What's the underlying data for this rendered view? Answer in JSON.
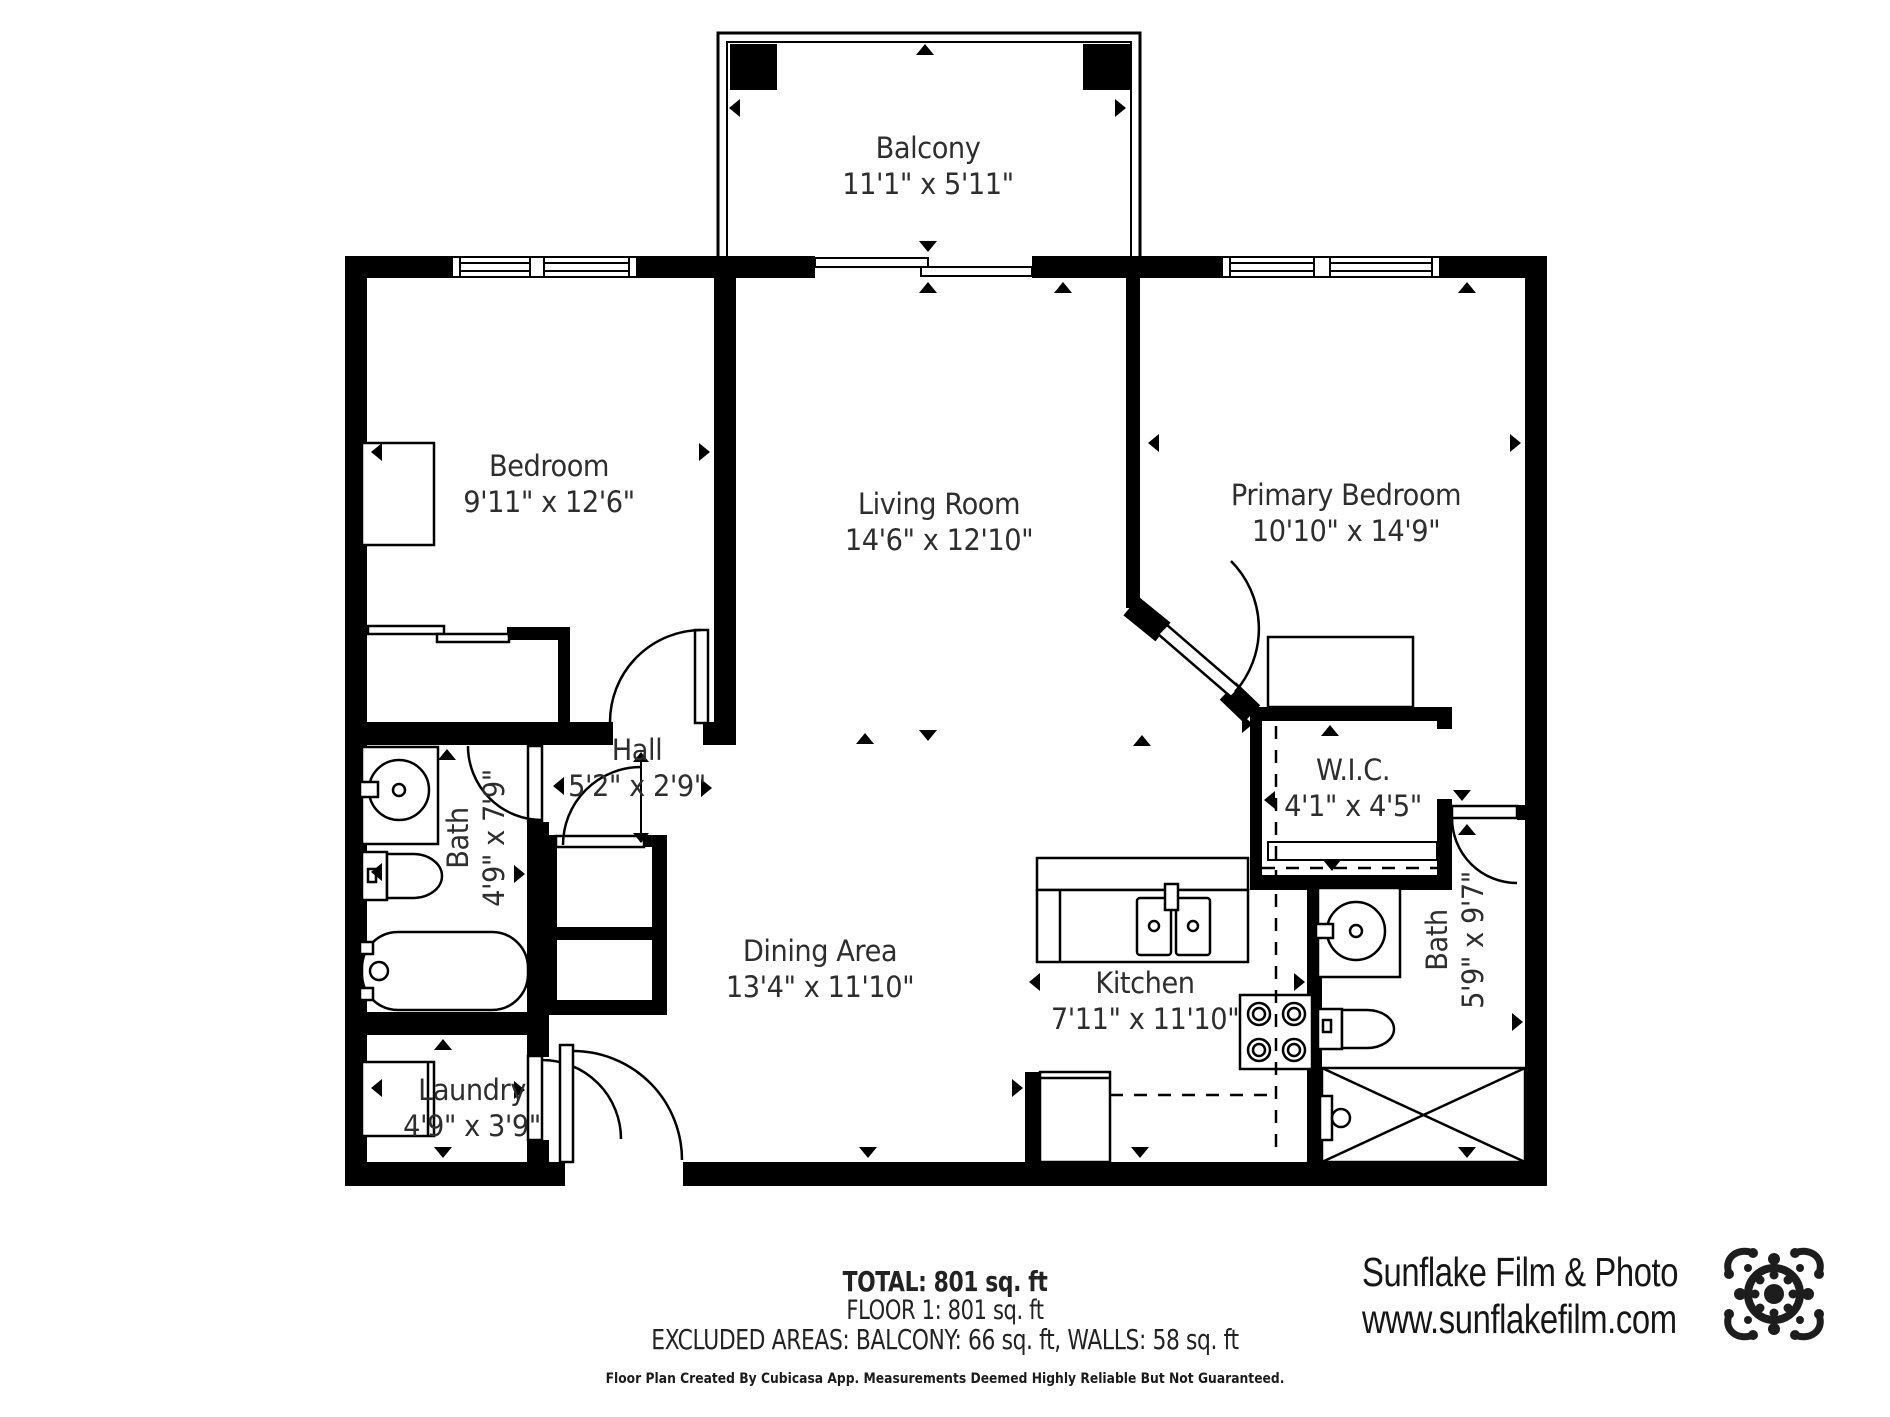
{
  "rooms": {
    "balcony": {
      "name": "Balcony",
      "dims": "11'1\" x 5'11\""
    },
    "bedroom": {
      "name": "Bedroom",
      "dims": "9'11\" x 12'6\""
    },
    "living_room": {
      "name": "Living Room",
      "dims": "14'6\" x 12'10\""
    },
    "primary_bedroom": {
      "name": "Primary Bedroom",
      "dims": "10'10\" x 14'9\""
    },
    "hall": {
      "name": "Hall",
      "dims": "5'2\" x 2'9\""
    },
    "bath_left": {
      "name": "Bath",
      "dims": "4'9\" x 7'9\""
    },
    "dining_area": {
      "name": "Dining Area",
      "dims": "13'4\" x 11'10\""
    },
    "kitchen": {
      "name": "Kitchen",
      "dims": "7'11\" x 11'10\""
    },
    "wic": {
      "name": "W.I.C.",
      "dims": "4'1\" x 4'5\""
    },
    "bath_right": {
      "name": "Bath",
      "dims": "5'9\" x 9'7\""
    },
    "laundry": {
      "name": "Laundry",
      "dims": "4'9\" x 3'9\""
    }
  },
  "footer": {
    "total": "TOTAL: 801 sq. ft",
    "floor": "FLOOR 1: 801 sq. ft",
    "excluded": "EXCLUDED AREAS: BALCONY: 66 sq. ft, WALLS: 58 sq. ft",
    "disclaimer": "Floor Plan Created By Cubicasa App. Measurements Deemed Highly Reliable But Not Guaranteed."
  },
  "watermark": {
    "company": "Sunflake Film & Photo",
    "website": "www.sunflakefilm.com"
  },
  "colors": {
    "walls": "#000000",
    "label_text": "#2e2e2e",
    "watermark_text": "#161616"
  }
}
